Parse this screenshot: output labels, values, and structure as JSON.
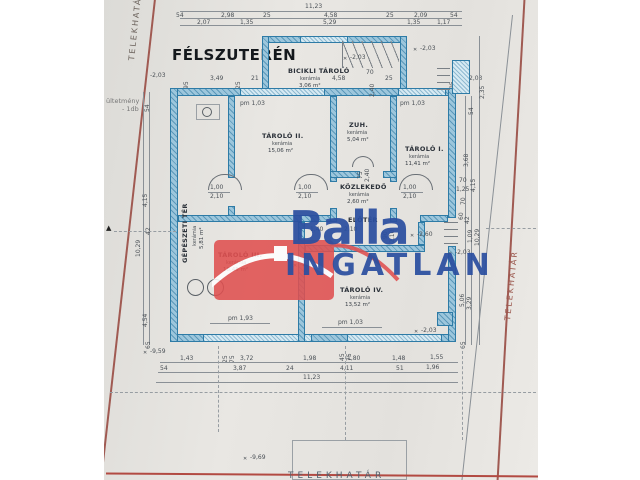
{
  "title": "FÉLSZUTERÉN",
  "watermark": {
    "brand": "Balla",
    "brand2": "INGATLAN",
    "brand_color": "#2b4fa0",
    "house_color": "#e05050"
  },
  "boundaries": {
    "left": "TELEKHATÁR",
    "right": "TELEKHATÁR",
    "bottom": "TELEKHATÁR"
  },
  "annotation": {
    "line1": "ültetmény",
    "line2": "- 1db"
  },
  "rooms": [
    {
      "name": "BICIKLI TÁROLÓ",
      "finish": "kerámia",
      "area": "3,06 m²"
    },
    {
      "name": "GÉPÉSZETI TÉR",
      "finish": "kerámia",
      "area": "5,81 m²"
    },
    {
      "name": "TÁROLÓ II.",
      "finish": "kerámia",
      "area": "15,06 m²"
    },
    {
      "name": "ZUH.",
      "finish": "kerámia",
      "area": "5,04 m²"
    },
    {
      "name": "TÁROLÓ I.",
      "finish": "kerámia",
      "area": "11,41 m²"
    },
    {
      "name": "KÖZLEKEDŐ",
      "finish": "kerámia",
      "area": "2,60 m²"
    },
    {
      "name": "ELŐTÉR",
      "finish": "",
      "area": ""
    },
    {
      "name": "TÁROLÓ III.",
      "finish": "kerámia",
      "area": "18,45 m²"
    },
    {
      "name": "TÁROLÓ IV.",
      "finish": "kerámia",
      "area": "13,52 m²"
    }
  ],
  "windows": {
    "top_left": "pm 1,03",
    "top_right": "pm 1,03",
    "bottom_left": "pm 1,93",
    "bottom_right": "pm 1,03"
  },
  "doors": {
    "width": "1,00",
    "height": "2,10",
    "zuh_width": "75",
    "zuh_height": "2,40",
    "entry_width": "90",
    "entry_height": "2,10",
    "eloter_dim1": "1,40",
    "eloter_dim2": "2,10"
  },
  "dims": {
    "top_total": "11,23",
    "top_row1": [
      "54",
      "2,98",
      "25",
      "4,58",
      "25",
      "2,09",
      "54"
    ],
    "top_row2": [
      "2,07",
      "1,35",
      "5,29",
      "1,35",
      "1,17"
    ],
    "wall_row": [
      "-2,03",
      "95",
      "3,49",
      "25",
      "21",
      "95",
      "25",
      "2,03"
    ],
    "bicikli": [
      "4,58",
      "70",
      "25",
      "2,40"
    ],
    "bottom_row1": [
      "1,43",
      "3,72",
      "1,98",
      "1,80",
      "1,48",
      "1,55"
    ],
    "bottom_row2": [
      "54",
      "3,87",
      "24",
      "4,11",
      "51",
      "1,96"
    ],
    "bottom_total": "11,23",
    "bottom_small": [
      "25",
      "75",
      "45",
      "75"
    ],
    "left_col": [
      "54",
      "4,15",
      "42",
      "4,54",
      "65",
      "10,29"
    ],
    "right_col": [
      "2,35",
      "54",
      "3,68",
      "4,15",
      "70",
      "1,25",
      "70",
      "60",
      "42",
      "1,09",
      "10,29",
      "5,06",
      "3,29",
      "65"
    ]
  },
  "levels": {
    "top_left": "-2,03",
    "bicikli": "-2,03",
    "top_right": "-2,03",
    "right_mid": "-2,03",
    "eloter": "-2,90",
    "taroloiv_right": "-2,60",
    "bottom_right": "-2,03",
    "site_left": "-9,59",
    "site_bottom": "-9,69"
  }
}
